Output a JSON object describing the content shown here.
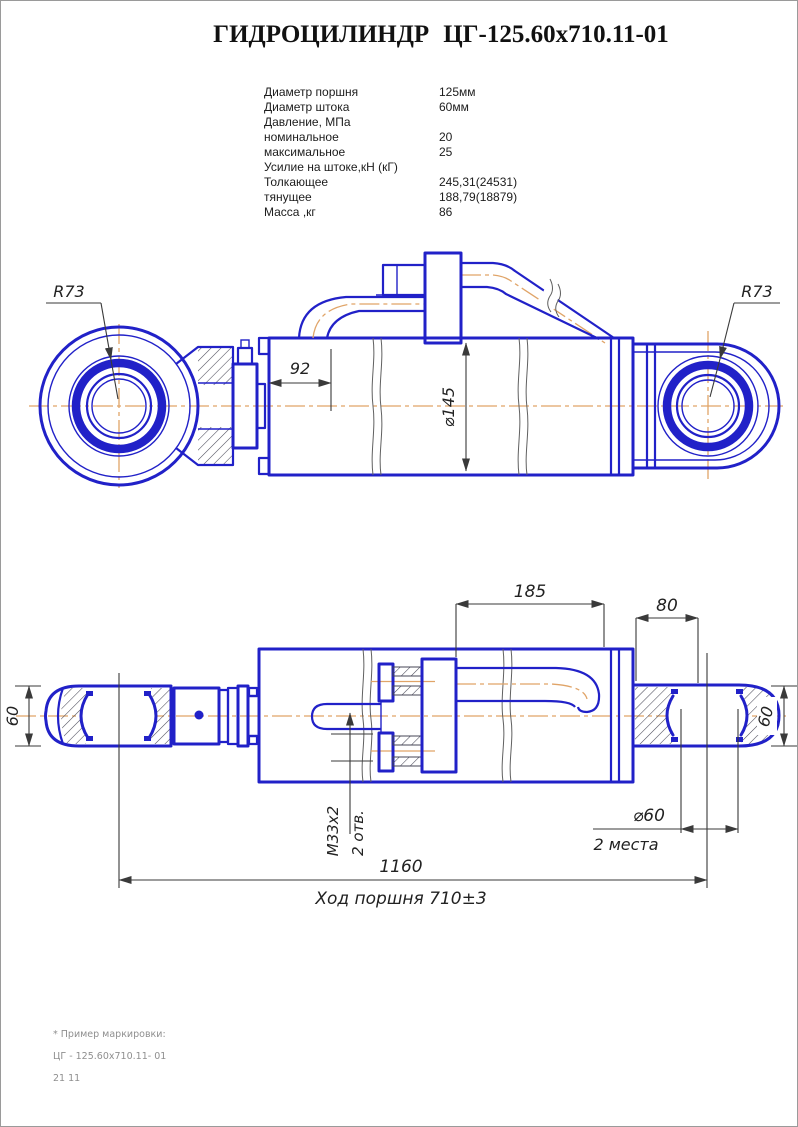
{
  "title": {
    "main": "ГИДРОЦИЛИНДР",
    "code": "ЦГ-125.60x710.11-01"
  },
  "specs": {
    "rows": [
      {
        "label": "Диаметр поршня",
        "value": "125мм"
      },
      {
        "label": "Диаметр штока",
        "value": "60мм"
      },
      {
        "label": "Давление, МПа",
        "value": ""
      },
      {
        "label": "номинальное",
        "value": "20"
      },
      {
        "label": "максимальное",
        "value": "25"
      },
      {
        "label": "Усилие на штоке,кН (кГ)",
        "value": ""
      },
      {
        "label": "Толкающее",
        "value": "245,31(24531)"
      },
      {
        "label": "тянущее",
        "value": "188,79(18879)"
      },
      {
        "label": "Масса ,кг",
        "value": "86"
      }
    ]
  },
  "drawing_top": {
    "dim_r73_left": "R73",
    "dim_r73_right": "R73",
    "dim_92": "92",
    "dim_d145": "⌀145"
  },
  "drawing_bottom": {
    "dim_185": "185",
    "dim_80": "80",
    "dim_60_left": "60",
    "dim_60_right": "60",
    "dim_m33": "М33х2",
    "dim_2otv": "2 отв.",
    "dim_d60": "⌀60",
    "dim_2mesta": "2 места",
    "dim_1160": "1160",
    "dim_stroke": "Ход поршня 710±3"
  },
  "footnote": {
    "line1": "* Пример маркировки:",
    "line2": "ЦГ - 125.60х710.11- 01",
    "line3": "21 11"
  },
  "colors": {
    "line_blue": "#2121c8",
    "centerline_orange": "#e0a468",
    "dim_gray": "#3a3a3a"
  }
}
